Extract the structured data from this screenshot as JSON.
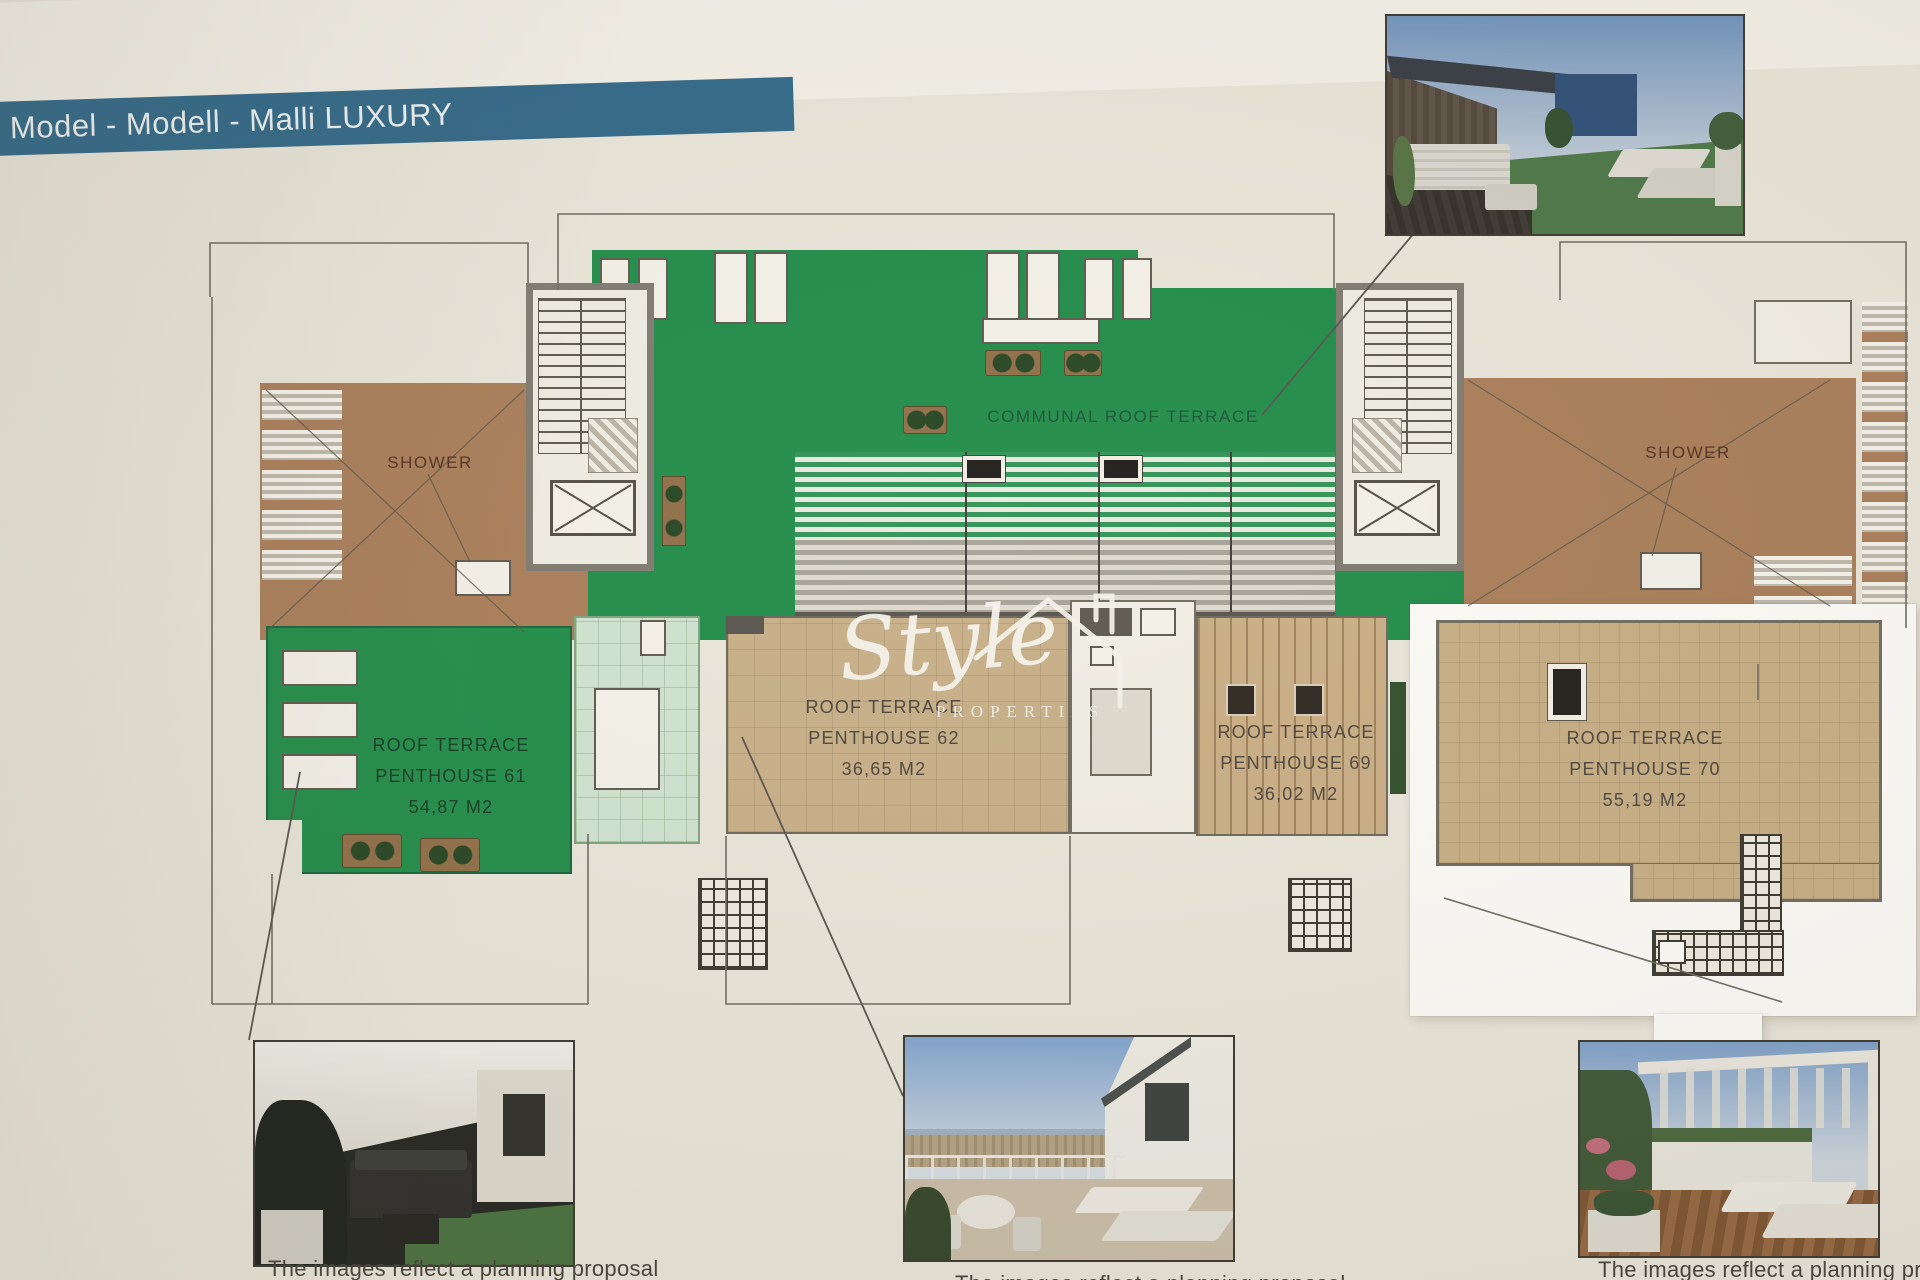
{
  "banner": {
    "title": "Model - Modell - Malli  LUXURY"
  },
  "plan": {
    "communal_label": "COMMUNAL ROOF TERRACE",
    "shower_left_label": "SHOWER",
    "shower_right_label": "SHOWER",
    "penthouses": [
      {
        "id": "61",
        "line1": "ROOF TERRACE",
        "line2": "PENTHOUSE 61",
        "area": "54,87 M2"
      },
      {
        "id": "62",
        "line1": "ROOF TERRACE",
        "line2": "PENTHOUSE 62",
        "area": "36,65 M2"
      },
      {
        "id": "69",
        "line1": "ROOF TERRACE",
        "line2": "PENTHOUSE 69",
        "area": "36,02 M2"
      },
      {
        "id": "70",
        "line1": "ROOF TERRACE",
        "line2": "PENTHOUSE 70",
        "area": "55,19 M2"
      }
    ]
  },
  "watermark": {
    "brand": "Style",
    "subtitle": "PROPERTIES"
  },
  "captions": {
    "left": "The images reflect a planning proposal",
    "middle": "The images reflect a planning proposal",
    "right": "The images reflect a planning proposal"
  },
  "colors": {
    "banner_teal": "#2f6787",
    "communal_green": "#1e8b47",
    "terracotta": "#a87c57",
    "tile_tan": "#c6ae86",
    "wood_deck": "#c9ad83",
    "mint_tile": "#d0e2cf",
    "paper": "#e9e5d9"
  }
}
